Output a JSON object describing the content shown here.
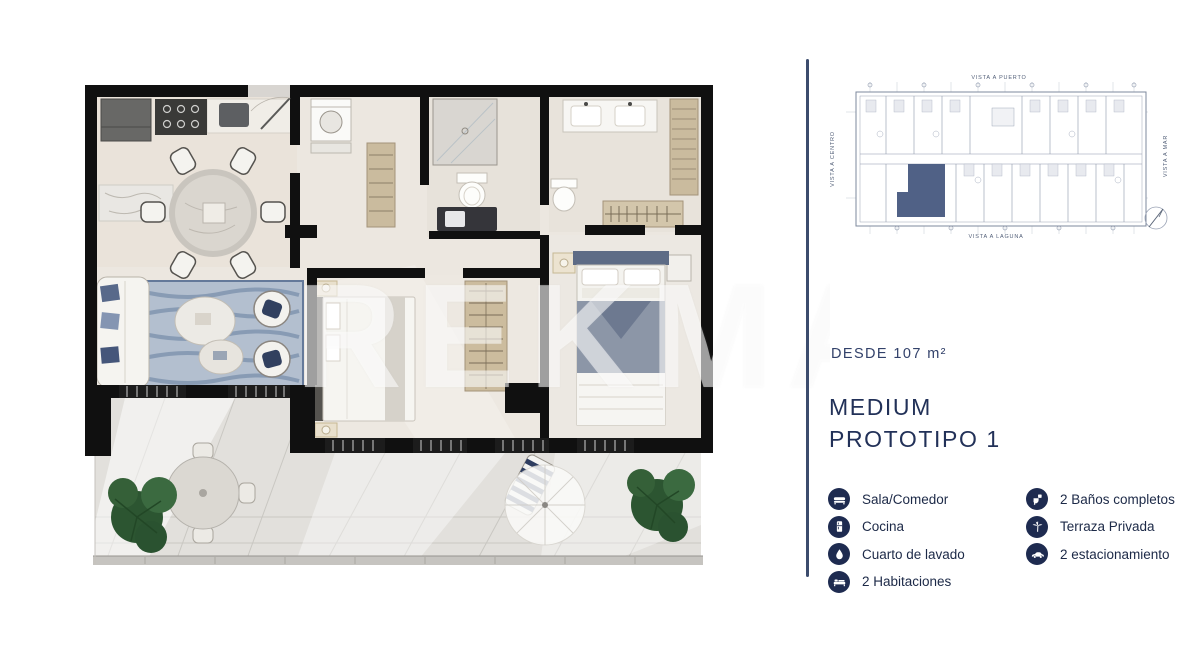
{
  "floorplan": {
    "watermark": "REKMAR"
  },
  "panel": {
    "mini_plan": {
      "label_top": "VISTA A PUERTO",
      "label_bottom": "VISTA A LAGUNA",
      "label_left": "VISTA A CENTRO",
      "label_right": "VISTA A MAR"
    },
    "area_label": "DESDE 107 m²",
    "title_line1": "MEDIUM",
    "title_line2": "PROTOTIPO 1",
    "features_left": [
      {
        "icon": "sofa-icon",
        "label": "Sala/Comedor"
      },
      {
        "icon": "fridge-icon",
        "label": "Cocina"
      },
      {
        "icon": "water-drop-icon",
        "label": "Cuarto de lavado"
      },
      {
        "icon": "bed-icon",
        "label": "2 Habitaciones"
      }
    ],
    "features_right": [
      {
        "icon": "toilet-icon",
        "label": "2 Baños completos"
      },
      {
        "icon": "palm-tree-icon",
        "label": "Terraza Privada"
      },
      {
        "icon": "car-icon",
        "label": "2 estacionamiento"
      }
    ],
    "colors": {
      "accent_navy": "#223158",
      "icon_circle": "#1e2b50",
      "divider": "#3c4c6d",
      "unit_highlight": "#47597f"
    }
  }
}
